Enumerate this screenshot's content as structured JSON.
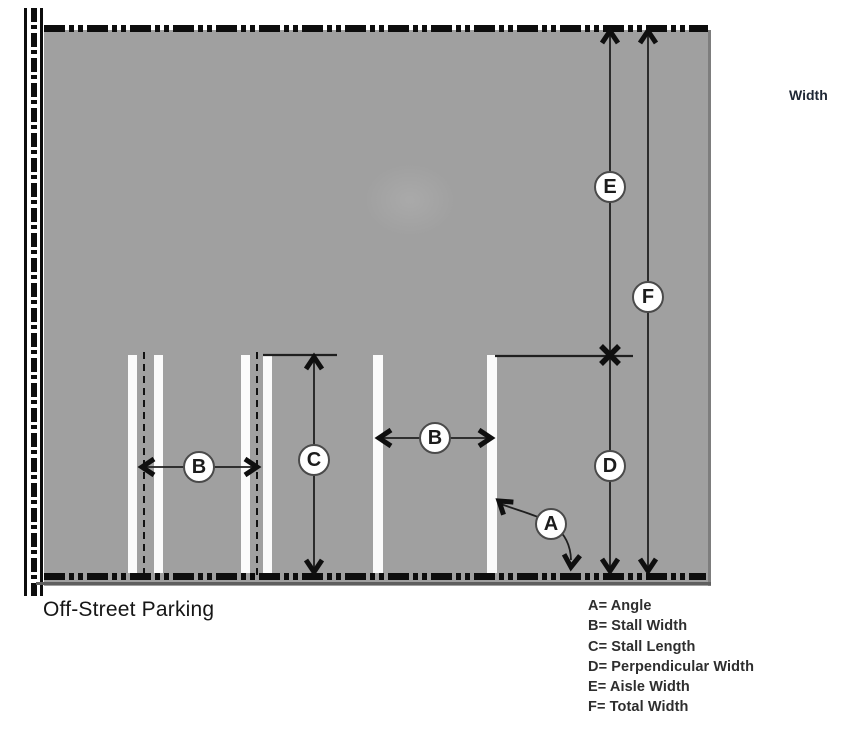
{
  "title": "Off-Street Parking",
  "width_label": "Width",
  "markers": {
    "angle": "A",
    "stall_width": "B",
    "stall_length": "C",
    "perpendicular_width": "D",
    "aisle_width": "E",
    "total_width": "F"
  },
  "legend": {
    "items": [
      "A= Angle",
      "B= Stall Width",
      "C= Stall Length",
      "D= Perpendicular Width",
      "E= Aisle Width",
      "F= Total Width"
    ]
  },
  "colors": {
    "surface": "#a0a0a0",
    "surface_edge": "#7d7d7d",
    "boundary_line": "#0d0d0d",
    "stall_line": "#fbfbfb",
    "dimension_line": "#1f1f1f",
    "badge_border": "#4a4a4a",
    "text": "#1c1c1c"
  }
}
